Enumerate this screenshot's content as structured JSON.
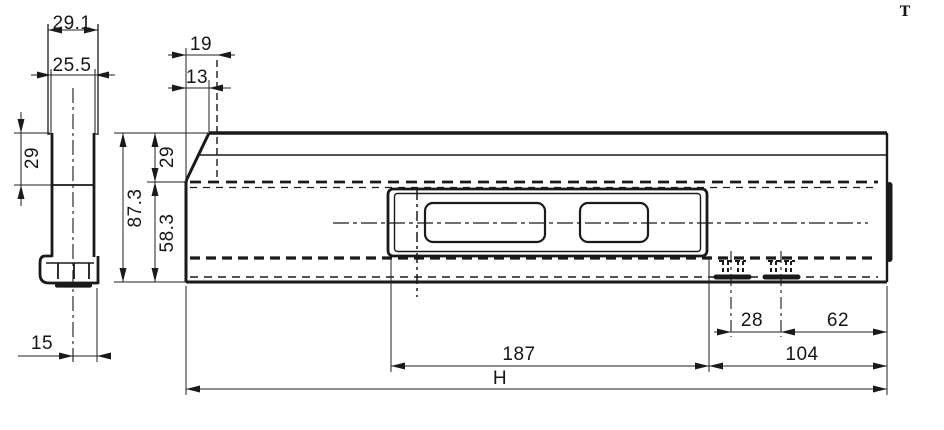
{
  "page": {
    "background": "#ffffff",
    "line_color": "#1a1a1a",
    "marker": "T"
  },
  "side_view": {
    "width_top": "29.1",
    "width_inner": "25.5",
    "height_upper": "29",
    "foot_offset": "15"
  },
  "front_view": {
    "top_offset": "19",
    "top_offset_inner": "13",
    "height_upper": "29",
    "height_total": "87.3",
    "height_lower": "58.3",
    "pocket_length": "187",
    "overall_length": "H",
    "clip_pitch": "28",
    "clip_to_end": "62",
    "end_zone": "104"
  }
}
